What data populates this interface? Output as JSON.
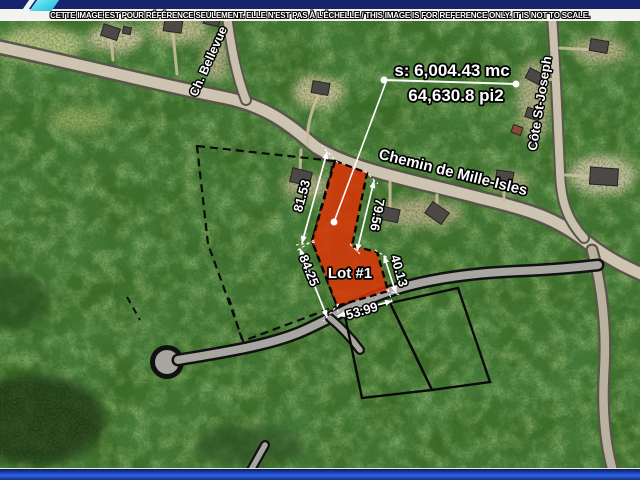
{
  "banner": {
    "disclaimer": "CETTE IMAGE EST POUR RÉFÉRENCE SEULEMENT. ELLE N'EST PAS À L'ÉCHELLE / THIS IMAGE IS FOR REFERENCE ONLY. IT IS NOT TO SCALE."
  },
  "map": {
    "area": {
      "metric": "s: 6,004.43 mc",
      "imperial": "64,630.8 pi2"
    },
    "lot": {
      "label": "Lot #1"
    },
    "roads": {
      "main": "Chemin de Mille-Isles",
      "northwest": "Ch. Bellevue",
      "east": "Côte St-Joseph"
    },
    "dimensions": {
      "west_upper": "81.53",
      "east_upper": "79.56",
      "west_lower": "84.25",
      "east_lower": "40.13",
      "south": "53.99"
    }
  },
  "colors": {
    "lot_fill": "#e53008",
    "brand_navy": "#16246d",
    "brand_cyan": "#23c2de",
    "footer_blue": "#1d46c0",
    "road_surface": "#cdc5b2"
  }
}
